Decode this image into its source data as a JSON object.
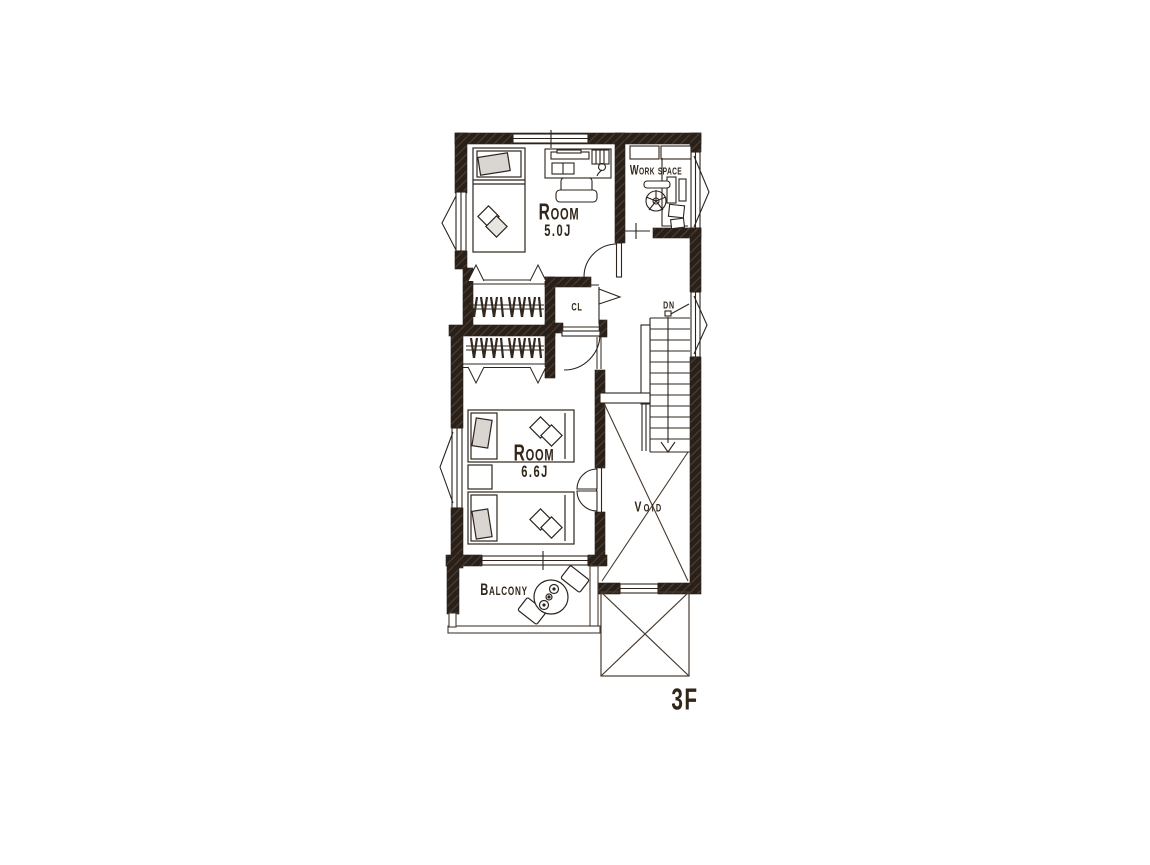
{
  "floor_plan": {
    "floor_label": "3F",
    "rooms": [
      {
        "name": "Room",
        "size": "5.0J"
      },
      {
        "name": "Work space",
        "size": ""
      },
      {
        "name": "CL",
        "size": ""
      },
      {
        "name": "Room",
        "size": "6.6J"
      },
      {
        "name": "Void",
        "size": ""
      },
      {
        "name": "Balcony",
        "size": ""
      }
    ],
    "stairs": {
      "label": "DN"
    },
    "colors": {
      "ink": "#2e241d",
      "wall_fill": "#2a201a",
      "cushion_fill": "#d9d6d1",
      "background": "#ffffff"
    }
  }
}
